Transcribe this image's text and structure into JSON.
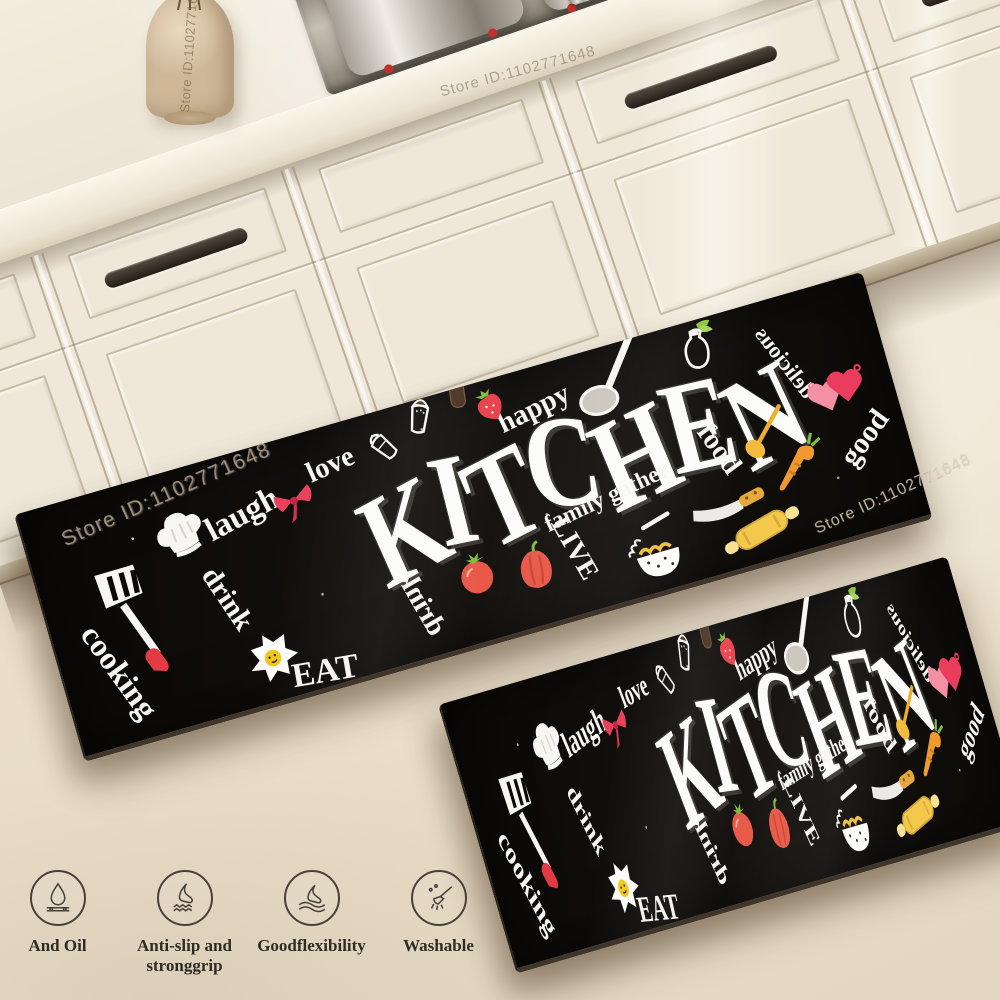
{
  "watermark": {
    "text": "Store ID:1102771648"
  },
  "features": {
    "items": [
      {
        "icon": "oil-drop-icon",
        "label": "And Oil"
      },
      {
        "icon": "anti-slip-icon",
        "label": "Anti-slip and\nstronggrip"
      },
      {
        "icon": "flexibility-icon",
        "label": "Goodflexibility"
      },
      {
        "icon": "washable-icon",
        "label": "Washable"
      }
    ]
  },
  "mat": {
    "base_color": "#0b0908",
    "accent_red": "#e8415c",
    "items": [
      {
        "type": "title",
        "text": "KITCHEN",
        "x": 523,
        "y": 103,
        "size": 96,
        "rot": -2,
        "sy": 1.28,
        "letter_rots": [
          -8,
          5,
          -7,
          8,
          -6,
          4,
          -9
        ],
        "letter_dys": [
          5,
          -6,
          3,
          -8,
          5,
          -3,
          6
        ]
      },
      {
        "type": "text",
        "text": "laugh",
        "x": 205,
        "y": 57,
        "rot": -12,
        "size": 31
      },
      {
        "type": "text",
        "text": "love",
        "x": 298,
        "y": 36,
        "rot": -8,
        "size": 27
      },
      {
        "type": "text",
        "text": "happy",
        "x": 497,
        "y": 38,
        "rot": -10,
        "size": 27
      },
      {
        "type": "text",
        "text": "drink",
        "x": 170,
        "y": 130,
        "rot": 72,
        "size": 27
      },
      {
        "type": "text",
        "text": "cooking",
        "x": 52,
        "y": 168,
        "rot": 70,
        "size": 30
      },
      {
        "type": "text",
        "text": "EAT",
        "x": 240,
        "y": 219,
        "rot": 6,
        "size": 32,
        "bold": true
      },
      {
        "type": "text",
        "text": "drink",
        "x": 345,
        "y": 184,
        "rot": 76,
        "size": 27,
        "mirror": true
      },
      {
        "type": "text",
        "text": "family gather",
        "x": 540,
        "y": 136,
        "rot": -9,
        "size": 22
      },
      {
        "type": "text",
        "text": "LIVE",
        "x": 498,
        "y": 174,
        "rot": 76,
        "size": 26,
        "bold": true
      },
      {
        "type": "text",
        "text": "food",
        "x": 655,
        "y": 122,
        "rot": 70,
        "size": 27
      },
      {
        "type": "text",
        "text": "good",
        "x": 790,
        "y": 150,
        "rot": -38,
        "size": 28
      },
      {
        "type": "text",
        "text": "delicious",
        "x": 737,
        "y": 62,
        "rot": 68,
        "size": 21,
        "mirror": true
      },
      {
        "type": "icon",
        "icon": "spatula-icon",
        "x": 82,
        "y": 122,
        "rot": 18,
        "size": 100
      },
      {
        "type": "icon",
        "icon": "chef-hat-icon",
        "x": 148,
        "y": 64,
        "rot": -10,
        "size": 62
      },
      {
        "type": "icon",
        "icon": "bow-icon",
        "x": 256,
        "y": 62,
        "rot": -8,
        "size": 46
      },
      {
        "type": "icon",
        "icon": "salt-shaker-icon",
        "x": 350,
        "y": 32,
        "rot": -35,
        "size": 42
      },
      {
        "type": "icon",
        "icon": "pepper-shaker-icon",
        "x": 392,
        "y": 14,
        "rot": 22,
        "size": 46
      },
      {
        "type": "icon",
        "icon": "pepper-mill-icon",
        "x": 432,
        "y": 2,
        "rot": 8,
        "size": 42
      },
      {
        "type": "icon",
        "icon": "strawberry-icon",
        "x": 458,
        "y": 26,
        "rot": -15,
        "size": 36
      },
      {
        "type": "icon",
        "icon": "ladle-icon",
        "x": 572,
        "y": 30,
        "rot": 0,
        "size": 74
      },
      {
        "type": "icon",
        "icon": "fried-egg-icon",
        "x": 196,
        "y": 196,
        "rot": -10,
        "size": 56
      },
      {
        "type": "icon",
        "icon": "tomato-icon",
        "x": 402,
        "y": 172,
        "rot": 0,
        "size": 50
      },
      {
        "type": "icon",
        "icon": "bell-pepper-icon",
        "x": 458,
        "y": 180,
        "rot": 8,
        "size": 54
      },
      {
        "type": "icon",
        "icon": "noodle-pot-icon",
        "x": 572,
        "y": 198,
        "rot": 0,
        "size": 68
      },
      {
        "type": "icon",
        "icon": "carrot-icon",
        "x": 722,
        "y": 152,
        "rot": 0,
        "size": 58
      },
      {
        "type": "icon",
        "icon": "wooden-spoon-icon",
        "x": 700,
        "y": 120,
        "rot": 0,
        "size": 52
      },
      {
        "type": "icon",
        "icon": "knife-icon",
        "x": 648,
        "y": 172,
        "rot": -6,
        "size": 78
      },
      {
        "type": "icon",
        "icon": "rolling-pin-icon",
        "x": 672,
        "y": 204,
        "rot": -14,
        "size": 82
      },
      {
        "type": "icon",
        "icon": "oil-bottle-icon",
        "x": 660,
        "y": 24,
        "rot": 6,
        "size": 50
      },
      {
        "type": "icon",
        "icon": "mitts-icon",
        "x": 778,
        "y": 100,
        "rot": 0,
        "size": 64
      }
    ]
  },
  "colors": {
    "floor": "#e8ddc8",
    "cabinet": "#f0e9da",
    "countertop": "#f2ecdf",
    "handle": "#3c332c",
    "cooktop_steel": "#a9a398",
    "mat_black": "#0b0908",
    "accent_red": "#e8415c",
    "veg_red": "#e85948",
    "utensil_yellow": "#f3c84b",
    "leaf_green": "#7fbf3f"
  }
}
